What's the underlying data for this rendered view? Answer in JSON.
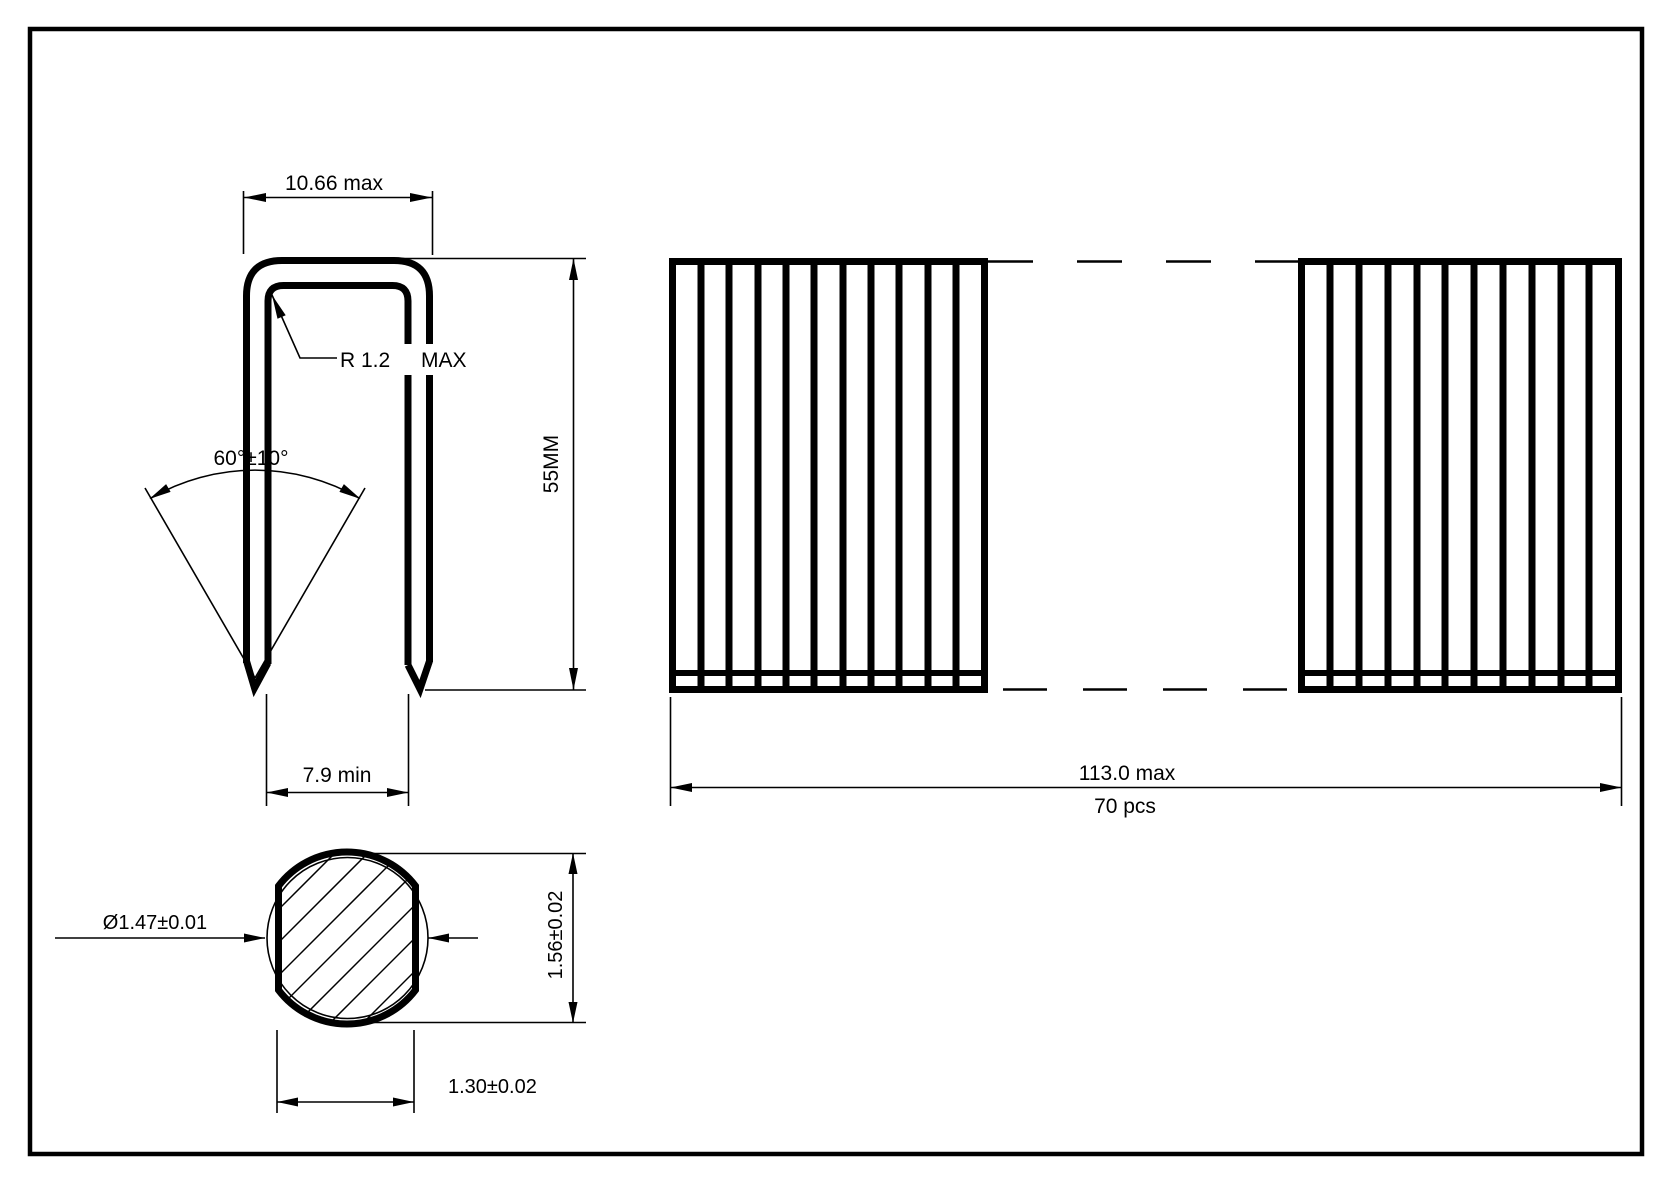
{
  "page": {
    "background_color": "#ffffff",
    "line_color": "#000000"
  },
  "views": {
    "profile": {
      "crown_width": "10.66 max",
      "corner_radius": "R 1.2",
      "corner_radius_qualifier": "MAX",
      "point_angle": "60°±10°",
      "leg_length": "55MM",
      "inside_width": "7.9 min"
    },
    "strip": {
      "length": "113.0 max",
      "count": "70 pcs"
    },
    "cross_section": {
      "diameter": "Ø1.47±0.01",
      "height": "1.56±0.02",
      "width": "1.30±0.02"
    }
  }
}
